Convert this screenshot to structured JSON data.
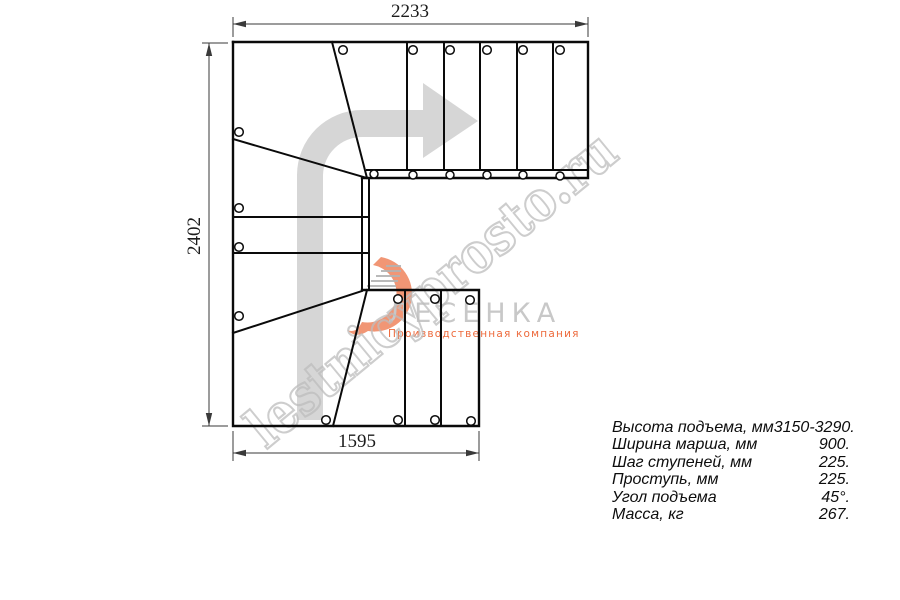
{
  "dimensions": {
    "top_mm": "2233",
    "left_mm": "2402",
    "bottom_mm": "1595"
  },
  "logo": {
    "brand": "ЛЕСЕНКА",
    "tagline": "Производственная компания"
  },
  "watermark": {
    "text": "lestnicyprosto.ru"
  },
  "specs": {
    "rows": [
      {
        "label": "Высота подъема, мм",
        "value": "3150-3290."
      },
      {
        "label": "Ширина марша, мм",
        "value": "900."
      },
      {
        "label": "Шаг ступеней, мм",
        "value": "225."
      },
      {
        "label": "Проступь, мм",
        "value": "225."
      },
      {
        "label": "Угол подъема",
        "value": "45°."
      },
      {
        "label": "Масса, кг",
        "value": "267."
      }
    ]
  },
  "colors": {
    "line": "#0a0a0a",
    "dimension": "#3a3a3a",
    "arrow_fill": "#d6d6d6",
    "watermark_gray": "#bdbdbd",
    "logo_gray": "#c8c8c8",
    "logo_orange": "#ed6a3c",
    "flame_orange": "#ee7c52"
  }
}
